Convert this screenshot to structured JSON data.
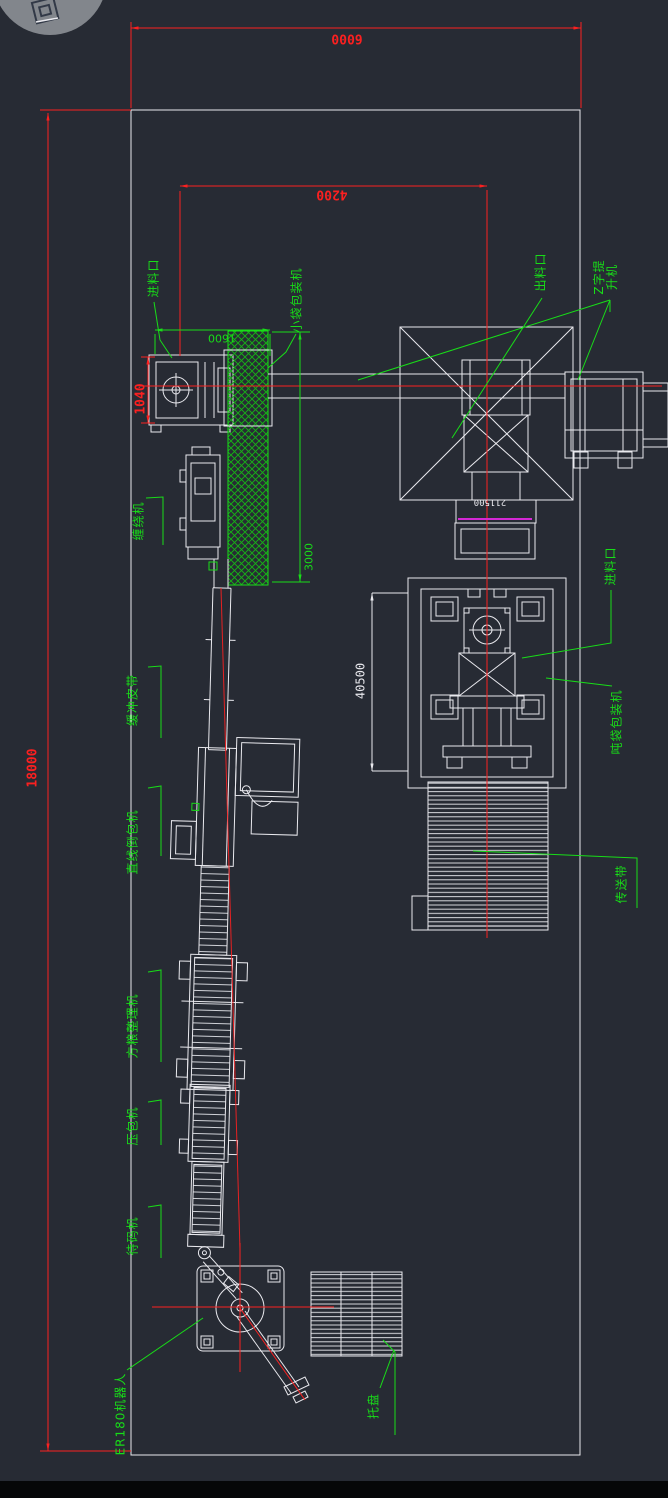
{
  "drawing": {
    "title": "packaging-line-plant-layout",
    "background": "#272b34"
  },
  "colors": {
    "dimension_red": "#fb2020",
    "annotation_green": "#18dd18",
    "geometry_white": "#e9e9ee",
    "magenta_line": "#d428d4"
  },
  "dims": {
    "overall_width": {
      "value": "6000"
    },
    "width_4200": {
      "value": "4200"
    },
    "width_1600": {
      "value": "1600"
    },
    "height_1040": {
      "value": "1040"
    },
    "length_3000": {
      "value": "3000"
    },
    "overall_length": {
      "value": "18000"
    },
    "length_40500": {
      "value": "40500"
    },
    "level_211500": {
      "value": "211500"
    }
  },
  "labels": {
    "feed_inlet_left": {
      "text": "进料口"
    },
    "small_bag_packer": {
      "text": "小袋包装机"
    },
    "discharge_outlet": {
      "text": "出料口"
    },
    "z_elevator": {
      "text": "Z字提升机"
    },
    "wrapping_machine": {
      "text": "缠绕机"
    },
    "buffer_belt": {
      "text": "缓冲皮带"
    },
    "inline_bag_turner": {
      "text": "直线倒包机"
    },
    "bag_shaping_machine": {
      "text": "方粮整理机"
    },
    "bag_press": {
      "text": "压包机"
    },
    "staging_conveyor": {
      "text": "待码机"
    },
    "robot": {
      "text": "ER180机器人"
    },
    "pallet": {
      "text": "托盘"
    },
    "feed_inlet_right": {
      "text": "进料口"
    },
    "ton_bag_packer": {
      "text": "吨袋包装机"
    },
    "conveyor_belt": {
      "text": "传送带"
    }
  }
}
